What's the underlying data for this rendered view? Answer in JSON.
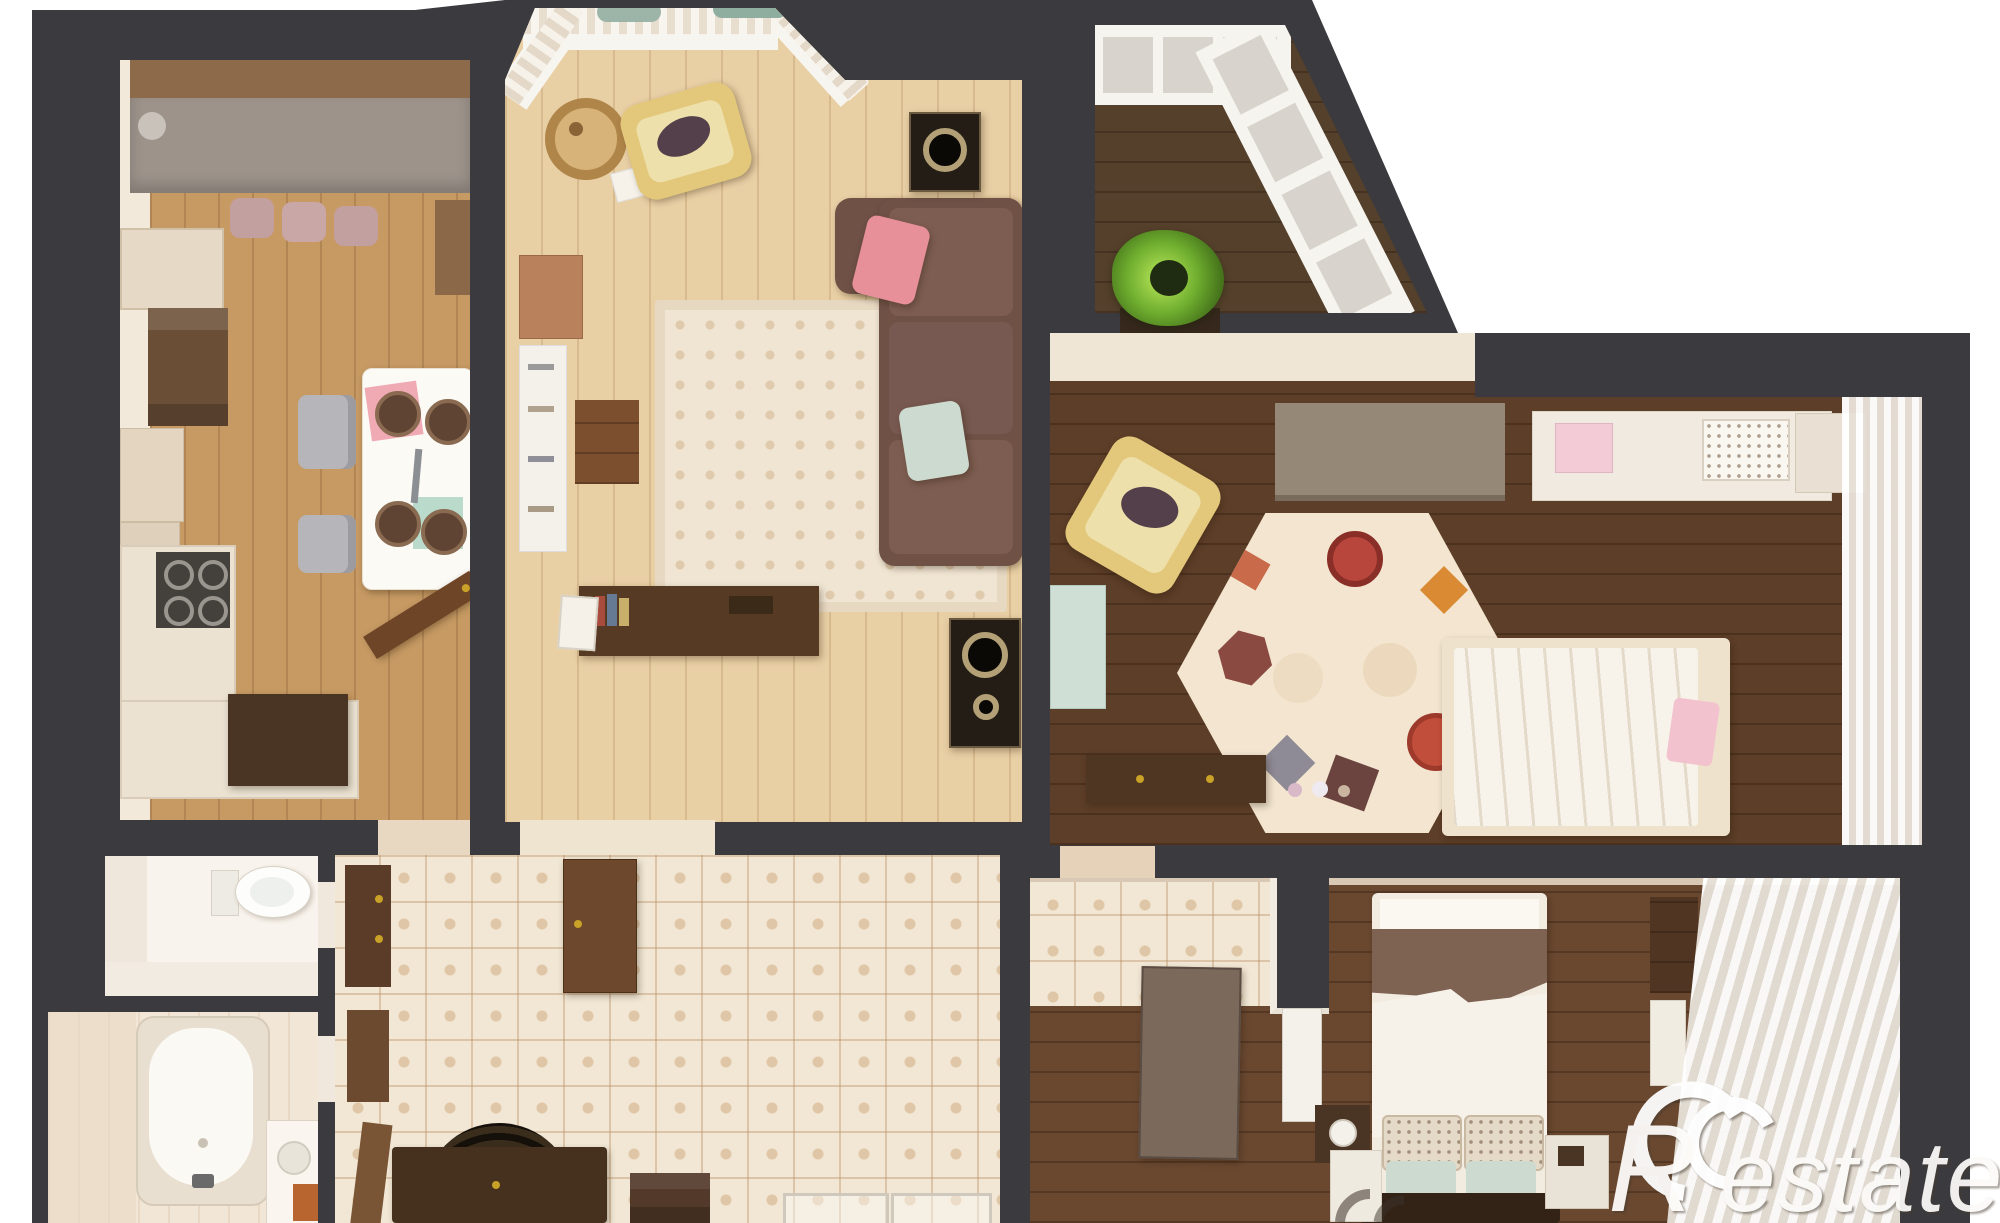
{
  "watermark": {
    "brand": "Restate",
    "logo_letter": "R",
    "wordmark": "estate",
    "color": "#fdfcfa"
  },
  "palette": {
    "wall": "#3b3a3e",
    "outside": "#ffffff",
    "cream-wall": "#f2e9db",
    "kitchen-floor": "#c79a63",
    "living-floor": "#e9cfa4",
    "bedroom1-floor": "#5d3e28",
    "bedroom2-floor": "#6a4830",
    "balcony-floor": "#55402b",
    "tile": "#f2e7d5",
    "tile-line": "#c09a6f",
    "counter-dark": "#4a3424",
    "wood-brown": "#8a5f3e",
    "sofa-brown": "#6f5146",
    "pillow-pink": "#e8909a",
    "pillow-mint": "#ccdacf",
    "chair-yellow": "#e3c87b",
    "rug-cream": "#f0e5d2",
    "curtain-white": "#f6f2ec",
    "plant-green": "#6fae2f",
    "bench-dark": "#46311f",
    "gold": "#c9a227"
  }
}
